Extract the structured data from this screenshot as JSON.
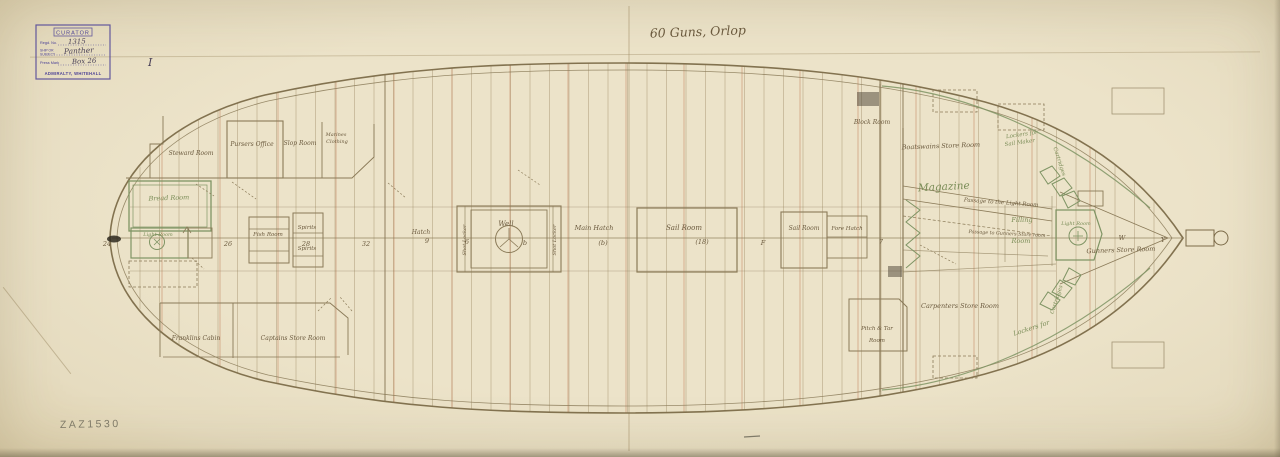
{
  "stamp": {
    "curator": "CURATOR",
    "regd_label": "Regd. No.",
    "regd_value": "1315",
    "ship_label_1": "SHIP OR",
    "ship_label_2": "SUBJECT",
    "ship_value": "Panther",
    "press_label": "Press Mark",
    "press_value": "Box 26",
    "numeral": "I",
    "footer": "ADMIRALTY, WHITEHALL"
  },
  "title": "60 Guns, Orlop",
  "pencil_ref": "ZAZ1530",
  "labels": {
    "steward_room": "Steward Room",
    "pursers_office": "Pursers Office",
    "slop_room": "Slop Room",
    "marines_1": "Marines",
    "marines_2": "Clothing",
    "bread_room": "Bread Room",
    "light_room_aft": "Light Room",
    "fish_room": "Fish Room",
    "spirits_upper": "Spirits",
    "spirits_lower": "Spirits",
    "franklins_cabin": "Franklins Cabin",
    "captains_store_room": "Captains Store Room",
    "hatch": "Hatch",
    "well": "Well",
    "shot_locker_left": "Shot Locker",
    "shot_locker_right": "Shot Locker",
    "main_hatch": "Main Hatch",
    "sail_room_large": "Sail Room",
    "sail_room_small": "Sail Room",
    "fore_hatch": "Fore Hatch",
    "block_room": "Block Room",
    "boatswains_store_room": "Boatswains Store Room",
    "lockers_sailmaker_1": "Lockers for",
    "lockers_sailmaker_2": "Sail Maker",
    "cartridges_top": "Cartridges",
    "magazine": "Magazine",
    "passage_light_room": "Passage to the Light Room",
    "filling_room_1": "Filling",
    "filling_room_2": "Room",
    "passage_gunners": "Passage to Gunners Store room",
    "light_room_fwd": "Light Room",
    "gunners_store_room": "Gunners Store Room",
    "carpenters_store_room": "Carpenters Store Room",
    "pitch_tar_1": "Pitch & Tar",
    "pitch_tar_2": "Room",
    "lockers_for_bottom": "Lockers for",
    "cartridges_bottom": "Cartridges"
  },
  "station_marks": [
    "24",
    "26",
    "28",
    "32",
    "9",
    "6",
    "b",
    "(b)",
    "(18)",
    "F",
    "7",
    "W",
    "Y"
  ]
}
